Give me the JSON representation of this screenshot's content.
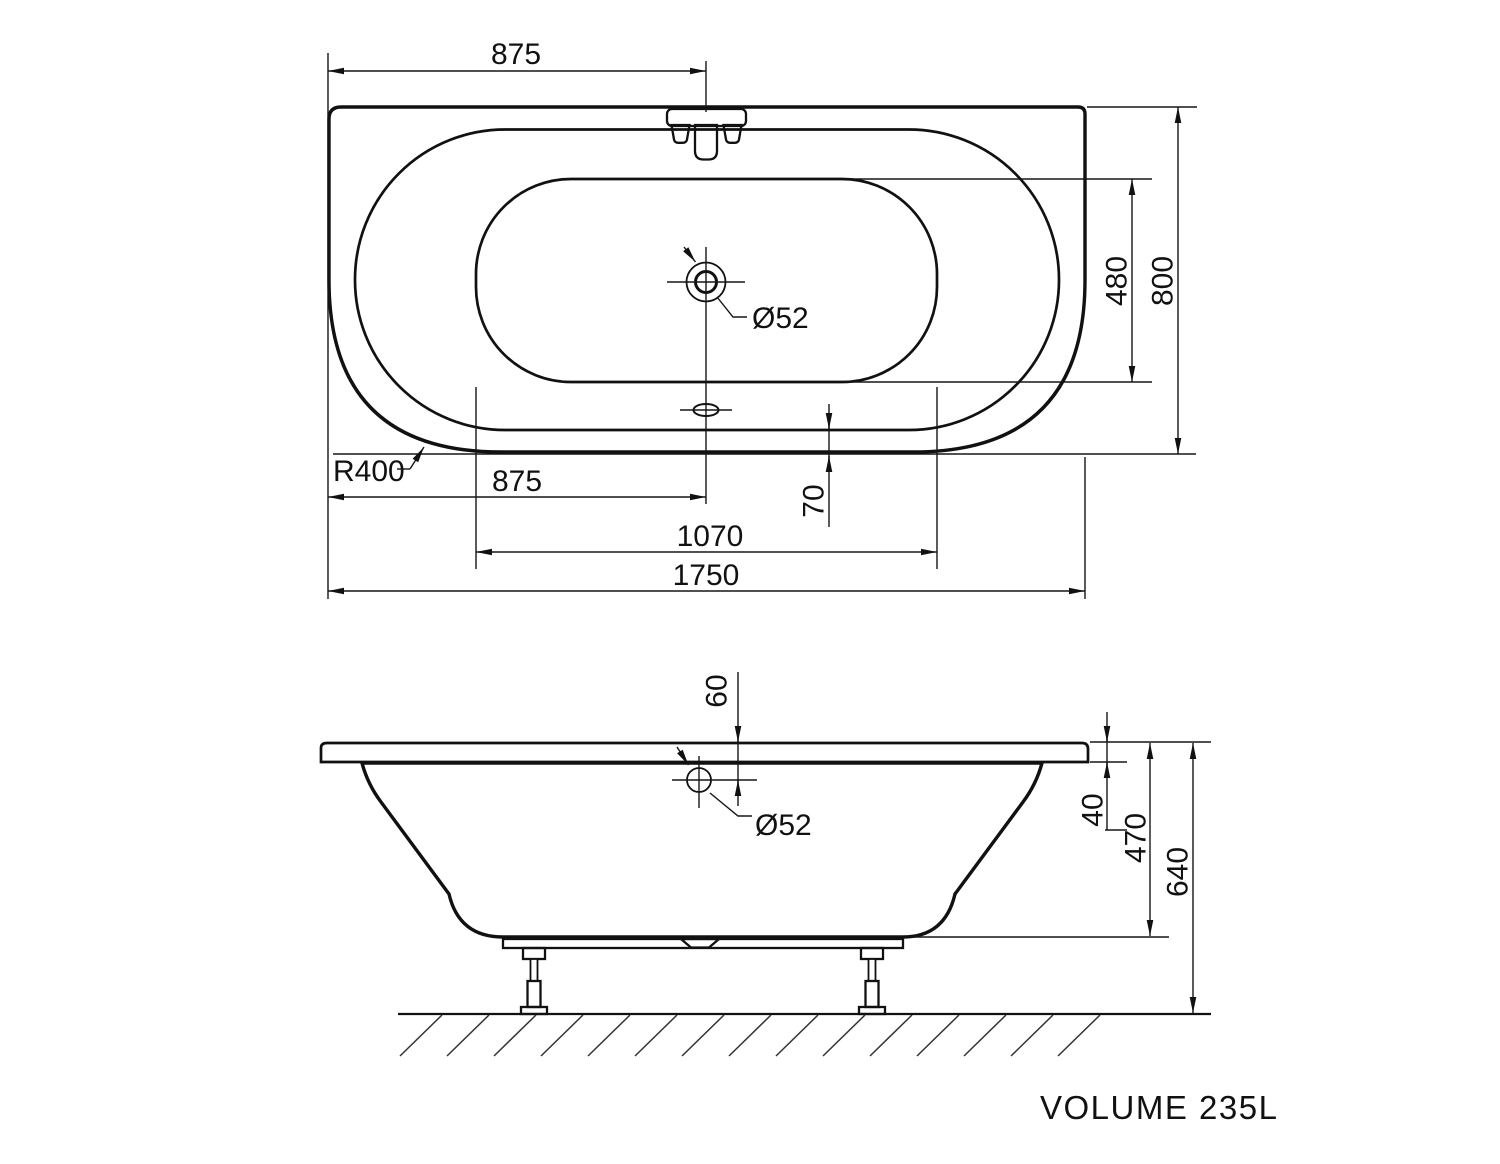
{
  "colors": {
    "line": "#111111",
    "plan_fill": "#e4e4e4",
    "plan_streak": "#eeeeee",
    "body_fill": "#ebebeb",
    "body_streak": "#f3f3f3",
    "faucet_fill": "#bdbdbd",
    "knob_fill": "#cccccc",
    "fitting_fill": "#dedede",
    "hole_fill": "#ffffff"
  },
  "plan_view": {
    "dim_faucet_from_left": "875",
    "dim_overall_width": "800",
    "dim_inner_width": "480",
    "drain_diameter_label": "Ø52",
    "corner_radius_label": "R400",
    "dim_drain_from_left": "875",
    "dim_rim_to_edge": "70",
    "dim_basin_length": "1070",
    "dim_overall_length": "1750"
  },
  "side_view": {
    "dim_hole_below_rim": "60",
    "hole_diameter_label": "Ø52",
    "dim_rim_height": "40",
    "dim_body_depth": "470",
    "dim_overall_height": "640"
  },
  "footer": {
    "volume_label": "VOLUME 235L"
  }
}
